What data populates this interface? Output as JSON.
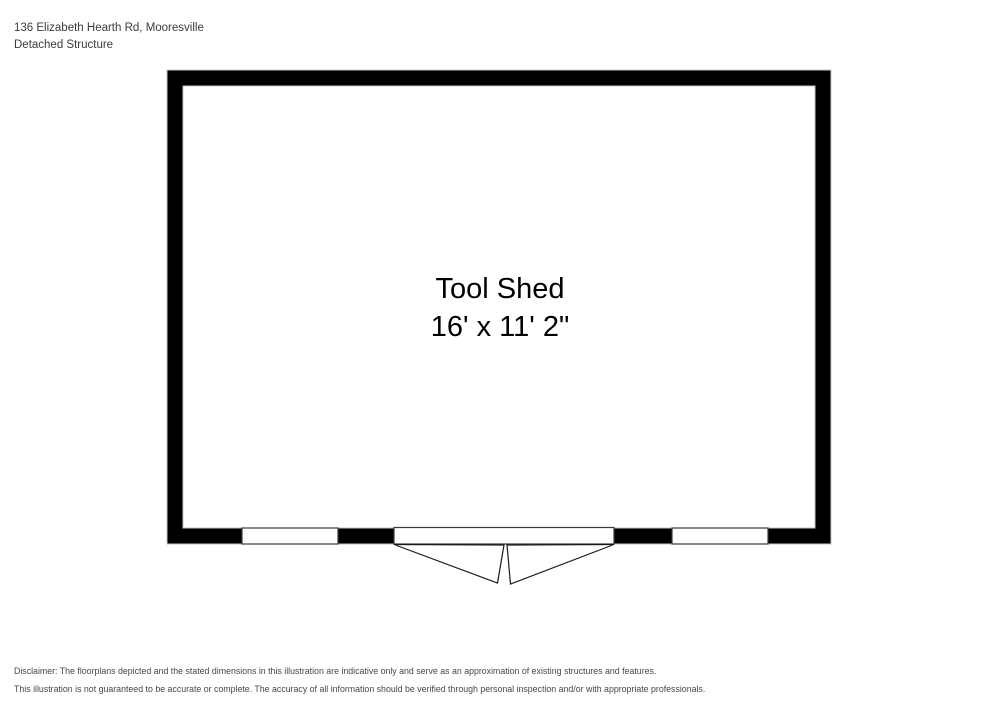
{
  "header": {
    "address": "136 Elizabeth Hearth Rd, Mooresville",
    "structure_type": "Detached Structure"
  },
  "room": {
    "name": "Tool Shed",
    "dimensions": "16' x 11' 2\""
  },
  "colors": {
    "wall": "#000000",
    "wall_outline": "#c4c4c4",
    "floor": "#ffffff",
    "opening_border": "#3a3a3a",
    "header_text": "#3b3b3b",
    "disclaimer_text": "#474747"
  },
  "disclaimer": {
    "line1": "Disclaimer: The floorplans depicted and the stated dimensions in this illustration are indicative only and serve as an approximation of existing structures and features.",
    "line2": "This illustration is not guaranteed to be accurate or complete. The accuracy of all information should be verified through personal inspection and/or with appropriate professionals."
  }
}
